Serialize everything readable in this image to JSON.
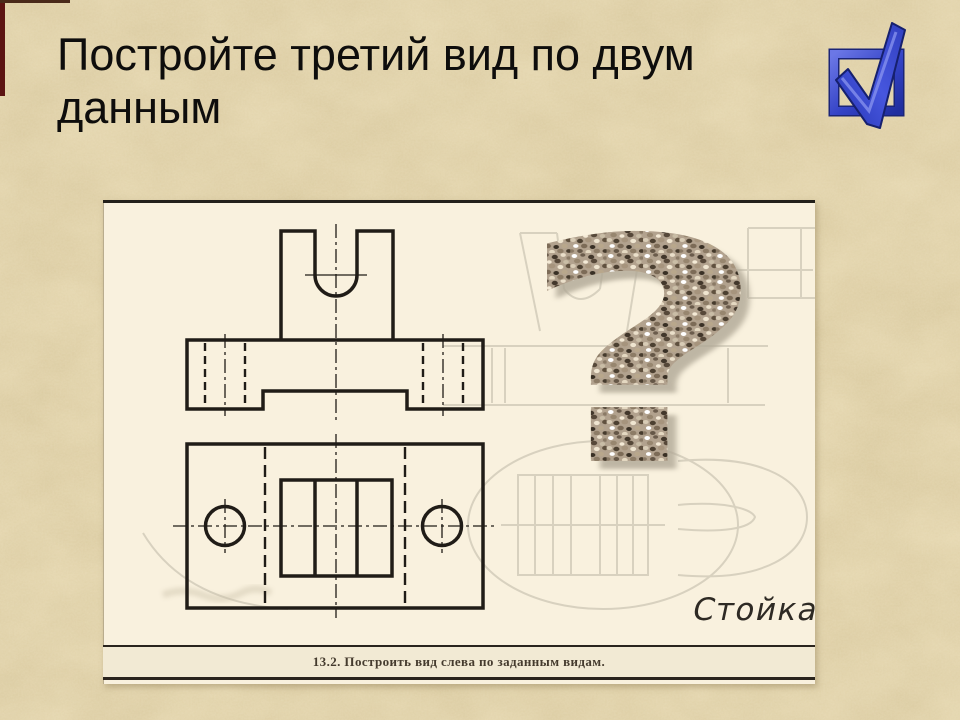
{
  "slide": {
    "title": "Постройте третий вид по двум данным"
  },
  "nav": {
    "check_icon": "blue-3d-checkbox",
    "accent_color": "#3a49cc"
  },
  "worksheet": {
    "question_mark": "?",
    "part_label": "Стойка",
    "caption": "13.2. Построить вид слева по заданным видам.",
    "paper_color": "#f9f1de",
    "ink_color": "#201c17",
    "ghost_line_color": "#d8d1bf",
    "speckle_base_color": "#b2a28e",
    "background_color": "#e7d9b2"
  }
}
